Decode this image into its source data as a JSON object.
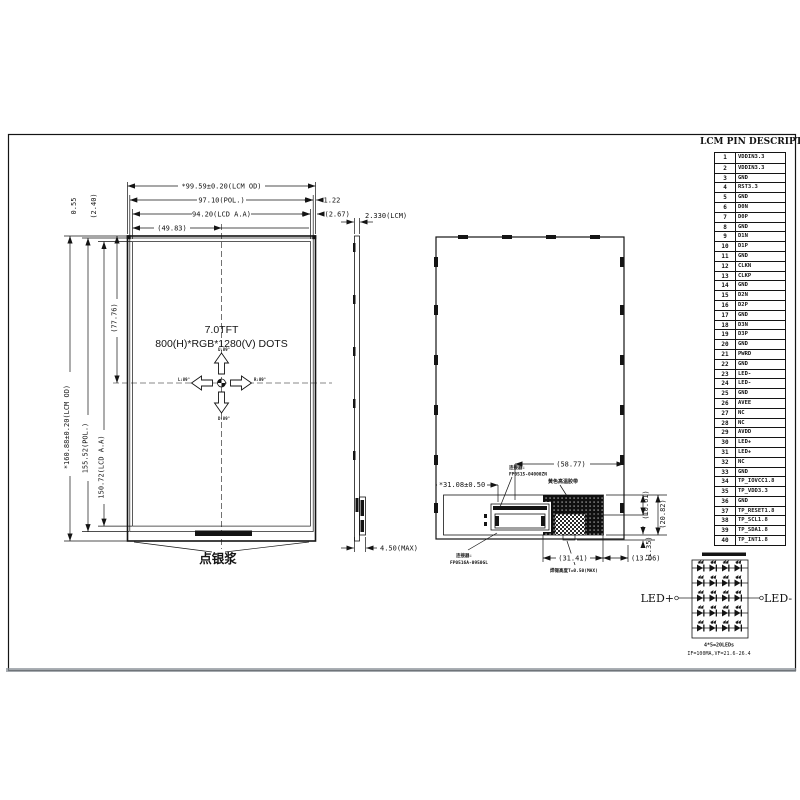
{
  "pin_table": {
    "title": "LCM PIN DESCRIPTION",
    "pins": [
      {
        "no": "1",
        "name": "VDDIN3.3"
      },
      {
        "no": "2",
        "name": "VDDIN3.3"
      },
      {
        "no": "3",
        "name": "GND"
      },
      {
        "no": "4",
        "name": "RST3.3"
      },
      {
        "no": "5",
        "name": "GND"
      },
      {
        "no": "6",
        "name": "D0N"
      },
      {
        "no": "7",
        "name": "D0P"
      },
      {
        "no": "8",
        "name": "GND"
      },
      {
        "no": "9",
        "name": "D1N"
      },
      {
        "no": "10",
        "name": "D1P"
      },
      {
        "no": "11",
        "name": "GND"
      },
      {
        "no": "12",
        "name": "CLKN"
      },
      {
        "no": "13",
        "name": "CLKP"
      },
      {
        "no": "14",
        "name": "GND"
      },
      {
        "no": "15",
        "name": "D2N"
      },
      {
        "no": "16",
        "name": "D2P"
      },
      {
        "no": "17",
        "name": "GND"
      },
      {
        "no": "18",
        "name": "D3N"
      },
      {
        "no": "19",
        "name": "D3P"
      },
      {
        "no": "20",
        "name": "GND"
      },
      {
        "no": "21",
        "name": "PWRD"
      },
      {
        "no": "22",
        "name": "GND"
      },
      {
        "no": "23",
        "name": "LED-"
      },
      {
        "no": "24",
        "name": "LED-"
      },
      {
        "no": "25",
        "name": "GND"
      },
      {
        "no": "26",
        "name": "AVEE"
      },
      {
        "no": "27",
        "name": "NC"
      },
      {
        "no": "28",
        "name": "NC"
      },
      {
        "no": "29",
        "name": "AVDD"
      },
      {
        "no": "30",
        "name": "LED+"
      },
      {
        "no": "31",
        "name": "LED+"
      },
      {
        "no": "32",
        "name": "NC"
      },
      {
        "no": "33",
        "name": "GND"
      },
      {
        "no": "34",
        "name": "TP_IOVCC1.8"
      },
      {
        "no": "35",
        "name": "TP_VDD3.3"
      },
      {
        "no": "36",
        "name": "GND"
      },
      {
        "no": "37",
        "name": "TP_RESET1.8"
      },
      {
        "no": "38",
        "name": "TP_SCL1.8"
      },
      {
        "no": "39",
        "name": "TP_SDA1.8"
      },
      {
        "no": "40",
        "name": "TP_INT1.8"
      }
    ]
  },
  "front_view": {
    "dim_width_od": "*99.59±0.20(LCM OD)",
    "dim_width_pol": "97.10(POL.)",
    "dim_width_aa": "94.20(LCD A.A)",
    "dim_width_half": "(49.83)",
    "dim_right_pol_gap": "1.22",
    "dim_right_aa_gap": "(2.67)",
    "dim_top_pol_gap": "0.55",
    "dim_top_aa_gap": "(2.40)",
    "dim_height_od": "*160.88±0.20(LCM OD)",
    "dim_height_pol": "155.52(POL.)",
    "dim_height_aa": "150.72(LCD A.A)",
    "dim_height_half": "(77.76)",
    "title_line1": "7.0TFT",
    "title_line2": "800(H)*RGB*1280(V) DOTS",
    "angles": {
      "up": "U:89°",
      "down": "D:89°",
      "left": "L:89°",
      "right": "R:89°"
    },
    "silver_paste_label": "点银浆"
  },
  "side_view": {
    "thickness": "2.330(LCM)",
    "max_thickness": "4.50(MAX)"
  },
  "back_view": {
    "offset_dim": "(58.77)",
    "fpc_width_dim": "*31.08±0.50",
    "connector_top_label": "连接器:",
    "connector_top_part": "FP0515-04000ZN",
    "connector_bottom_label": "连接器:",
    "connector_bottom_part": "FP0516A-0950GL",
    "tape_label": "黄色高温胶带",
    "solder_label": "焊锡高度T=0.50(MAX)",
    "dim_10_61": "(10.61)",
    "dim_20_82": "(20.82)",
    "dim_1_35": "(1.35)",
    "dim_31_41": "(31.41)",
    "dim_13_06": "(13.06)"
  },
  "led_circuit": {
    "left_terminal": "LED+",
    "right_terminal": "LED-",
    "count_label": "4*5=20LEDs",
    "spec_label": "IF=100MA,VF=21.6-26.4",
    "rows": 5,
    "cols": 4
  }
}
